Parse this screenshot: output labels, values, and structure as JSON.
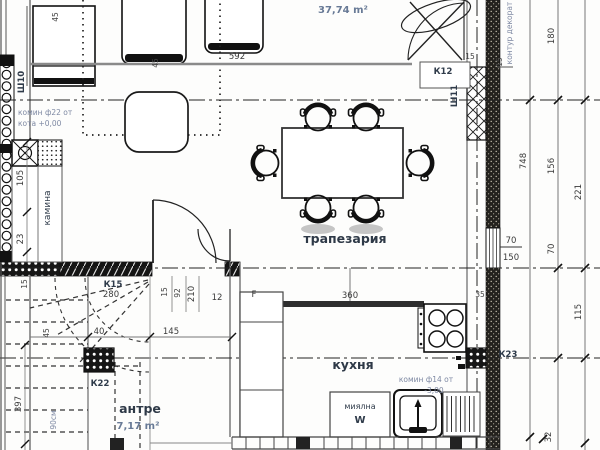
{
  "rooms": {
    "living_area": "37,74 m²",
    "dining_label": "трапезария",
    "kitchen_label": "кухня",
    "hall_label": "антре",
    "hall_area": "7,17 m²",
    "fireplace_label": "камина",
    "dishwasher_label": "миялна",
    "dishwasher_letter": "W"
  },
  "notes": {
    "chimney22_l1": "комин ф22 от",
    "chimney22_l2": "кота +0,00",
    "chimney14_l1": "комин ф14 от",
    "chimney14_l2": "-3,00",
    "decor_contour": "контур декорат",
    "stair_height": "90см"
  },
  "marks": {
    "k12": "К12",
    "k15": "К15",
    "k22": "К22",
    "k23": "К23",
    "sh10": "Ш10",
    "sh11": "Ш11",
    "f_mark": "F"
  },
  "dims": {
    "d592": "592",
    "d45_sofa": "45",
    "d45_chair": "45",
    "d105": "105",
    "d23": "23",
    "d180": "180",
    "d748": "748",
    "d156": "156",
    "d221": "221",
    "d70_window": "70",
    "d150_window": "150",
    "d70_right": "70",
    "d115": "115",
    "d32": "32",
    "d35": "35",
    "d360": "360",
    "d280": "280",
    "d15_stair": "15",
    "d45_stair": "45",
    "d40": "40",
    "d145": "145",
    "d397": "397",
    "d210": "210",
    "d92": "92",
    "d15_door": "15",
    "d12": "12",
    "d15_contour": "15",
    "d15_wall": "15"
  }
}
